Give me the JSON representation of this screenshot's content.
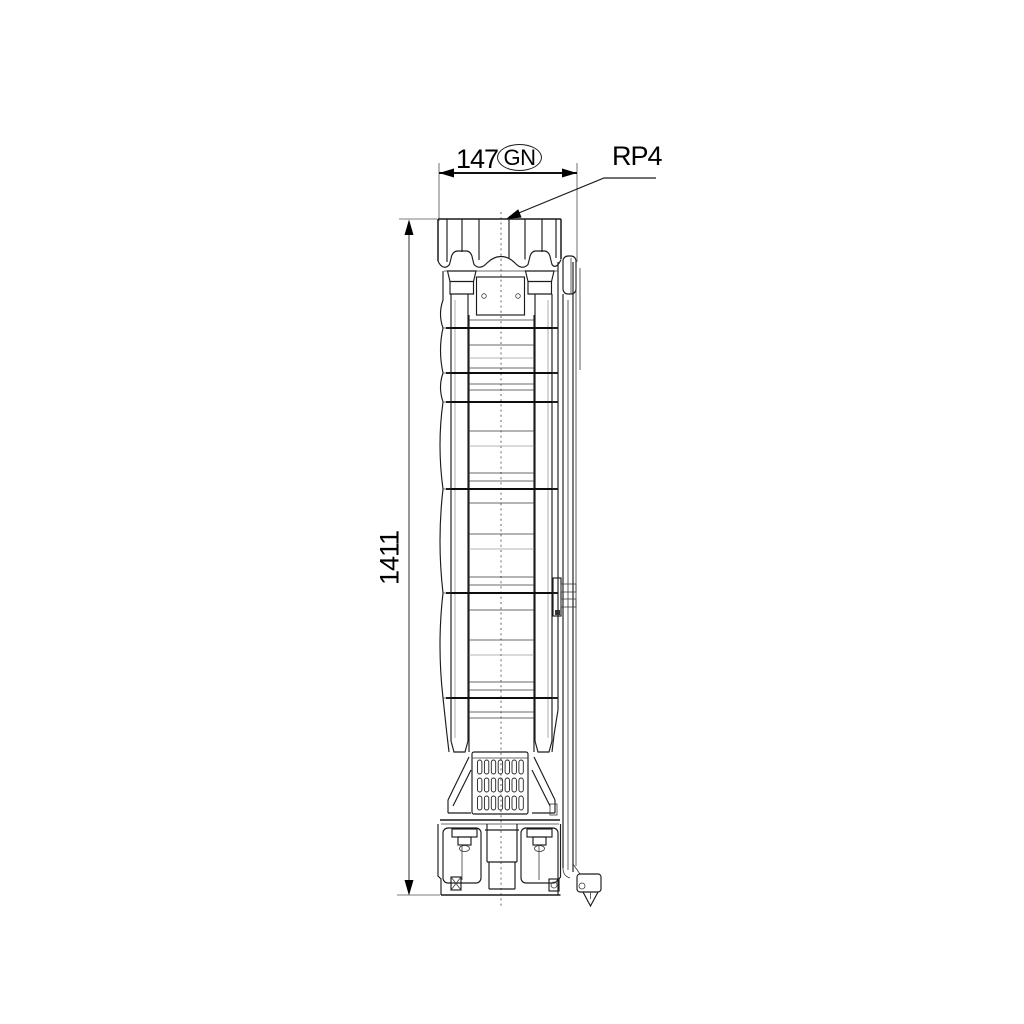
{
  "labels": {
    "width_dimension": "147",
    "width_dimension_tag": "GN",
    "top_connection": "RP4",
    "height_dimension": "1411"
  },
  "colors": {
    "background": "#ffffff",
    "line": "#1c1c1c",
    "dimension_line": "#7d7d7d",
    "text": "#000000"
  }
}
